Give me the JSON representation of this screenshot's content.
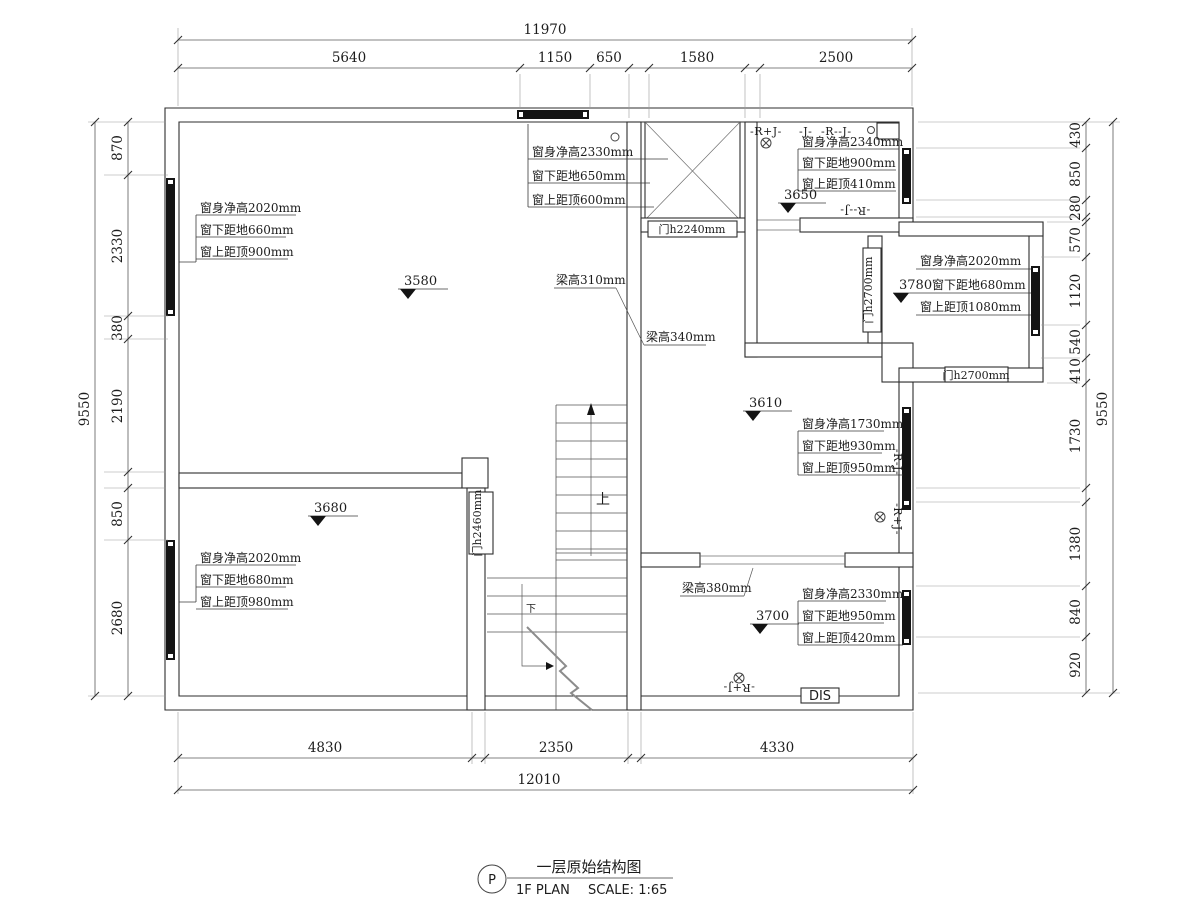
{
  "title": {
    "bubble": "P",
    "cn": "一层原始结构图",
    "en": "1F PLAN",
    "scale": "SCALE: 1:65"
  },
  "dims": {
    "top": {
      "total": "11970",
      "segments": [
        "5640",
        "1150",
        "650",
        "1580",
        "2500"
      ]
    },
    "bottom": {
      "total": "12010",
      "segments": [
        "4830",
        "2350",
        "4330"
      ]
    },
    "left": {
      "total": "9550",
      "segments": [
        "870",
        "2330",
        "380",
        "2190",
        "850",
        "2680"
      ]
    },
    "right": {
      "total": "9550",
      "segments": [
        "430",
        "850",
        "280",
        "570",
        "1120",
        "540",
        "410",
        "1730",
        "1380",
        "840",
        "920"
      ]
    }
  },
  "windows": {
    "tl": [
      "窗身净高2020mm",
      "窗下距地660mm",
      "窗上距顶900mm"
    ],
    "top": [
      "窗身净高2330mm",
      "窗下距地650mm",
      "窗上距顶600mm"
    ],
    "tr": [
      "窗身净高2340mm",
      "窗下距地900mm",
      "窗上距顶410mm"
    ],
    "right": [
      "窗身净高2020mm",
      "窗下距地680mm",
      "窗上距顶1080mm"
    ],
    "mid": [
      "窗身净高1730mm",
      "窗下距地930mm",
      "窗上距顶950mm"
    ],
    "br": [
      "窗身净高2330mm",
      "窗下距地950mm",
      "窗上距顶420mm"
    ],
    "bl": [
      "窗身净高2020mm",
      "窗下距地680mm",
      "窗上距顶980mm"
    ]
  },
  "beams": {
    "b310": "梁高310mm",
    "b340": "梁高340mm",
    "b380": "梁高380mm"
  },
  "doors": {
    "d2240": "门h2240mm",
    "d2460": "门h2460mm",
    "d2700a": "门h2700mm",
    "d2700b": "门h2700mm"
  },
  "levels": {
    "l3580": "3580",
    "l3650": "3650",
    "l3610": "3610",
    "l3680": "3680",
    "l3700": "3700",
    "l3780": "3780"
  },
  "marks": {
    "rj_top_left": "-R+J-",
    "j_top": "-J-",
    "rj_top_right": "-R--J-",
    "rj_tr_bottom": "-R--J-",
    "rj_wall_upper": "-R-J-",
    "rj_wall_lower": "-R+J-",
    "rj_br": "-R+J-",
    "dis": "DIS",
    "up": "上",
    "down": "下"
  }
}
